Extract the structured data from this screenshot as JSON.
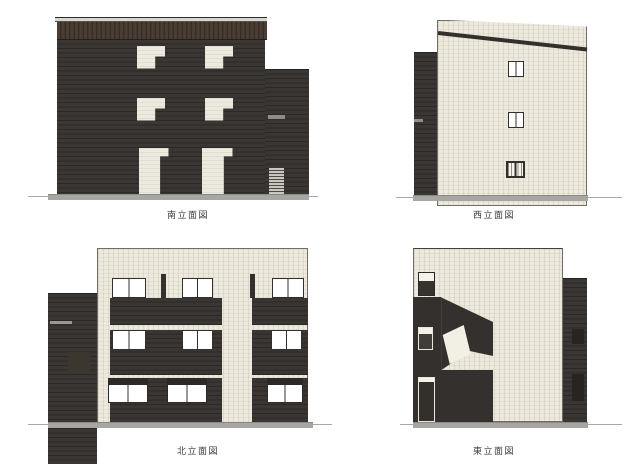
{
  "elevations": {
    "south": {
      "label": "南立面図"
    },
    "west": {
      "label": "西立面図"
    },
    "north": {
      "label": "北立面図"
    },
    "east": {
      "label": "東立面図"
    }
  },
  "palette": {
    "dark_siding": "#34302d",
    "parapet_brown": "#46392f",
    "cream_wall": "#edeadd",
    "window_white": "#ffffff",
    "ground_gray": "#a8a6a2",
    "page_background": "#ffffff"
  }
}
